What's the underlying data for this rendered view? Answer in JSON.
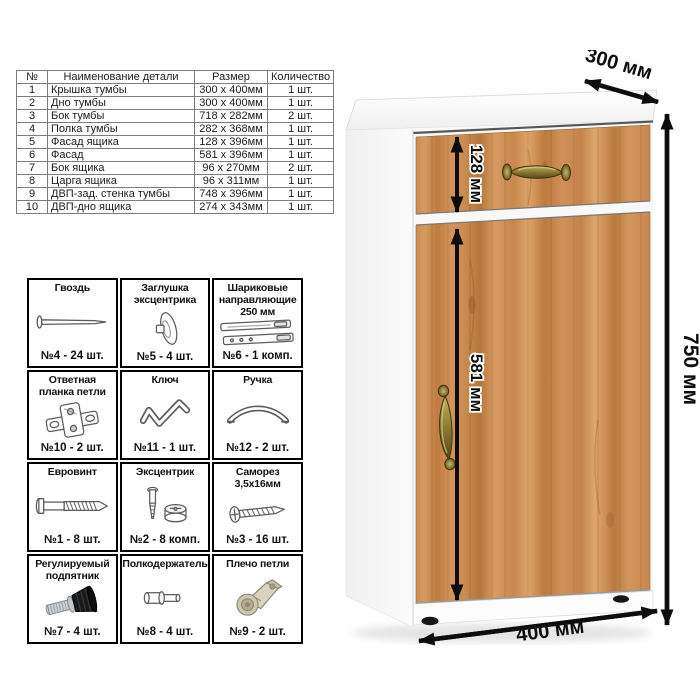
{
  "parts_table": {
    "headers": [
      "№",
      "Наименование детали",
      "Размер",
      "Количество"
    ],
    "rows": [
      [
        "1",
        "Крышка тумбы",
        "300 x 400мм",
        "1 шт."
      ],
      [
        "2",
        "Дно тумбы",
        "300 x 400мм",
        "1 шт."
      ],
      [
        "3",
        "Бок тумбы",
        "718 x 282мм",
        "2 шт."
      ],
      [
        "4",
        "Полка тумбы",
        "282 x 368мм",
        "1 шт."
      ],
      [
        "5",
        "Фасад ящика",
        "128 x 396мм",
        "1 шт."
      ],
      [
        "6",
        "Фасад",
        "581 x 396мм",
        "1 шт."
      ],
      [
        "7",
        "Бок ящика",
        "96 x 270мм",
        "2 шт."
      ],
      [
        "8",
        "Царга ящика",
        "96 x 311мм",
        "1 шт."
      ],
      [
        "9",
        "ДВП-зад. стенка тумбы",
        "748 x 396мм",
        "1 шт."
      ],
      [
        "10",
        "ДВП-дно ящика",
        "274 x 343мм",
        "1 шт."
      ]
    ]
  },
  "hardware": {
    "items": [
      {
        "name": "Гвоздь",
        "icon": "nail-icon",
        "count": "№4 - 24 шт."
      },
      {
        "name": "Заглушка эксцентрика",
        "icon": "cam-cap-icon",
        "count": "№5 - 4 шт."
      },
      {
        "name": "Шариковые направляющие 250 мм",
        "icon": "ball-slides-icon",
        "count": "№6 - 1 комп."
      },
      {
        "name": "Ответная планка петли",
        "icon": "hinge-plate-icon",
        "count": "№10 - 2 шт."
      },
      {
        "name": "Ключ",
        "icon": "hex-key-icon",
        "count": "№11 - 1 шт."
      },
      {
        "name": "Ручка",
        "icon": "handle-icon",
        "count": "№12 - 2 шт."
      },
      {
        "name": "Евровинт",
        "icon": "confirmat-screw-icon",
        "count": "№1 - 8 шт."
      },
      {
        "name": "Эксцентрик",
        "icon": "cam-lock-icon",
        "count": "№2 - 8 комп."
      },
      {
        "name": "Саморез 3,5х16мм",
        "icon": "screw-icon",
        "count": "№3 - 16 шт."
      },
      {
        "name": "Регулируемый подпятник",
        "icon": "adjustable-foot-icon",
        "count": "№7 - 4 шт."
      },
      {
        "name": "Полкодержатель",
        "icon": "shelf-pin-icon",
        "count": "№8 - 4 шт."
      },
      {
        "name": "Плечо петли",
        "icon": "hinge-arm-icon",
        "count": "№9 - 2 шт."
      }
    ]
  },
  "dimensions": {
    "depth": "300 мм",
    "height": "750 мм",
    "drawer_front": "128 мм",
    "door": "581 мм",
    "width": "400 мм"
  },
  "colors": {
    "wood_mid": "#c8874c",
    "wood_light": "#dda468",
    "wood_dark": "#b4763a",
    "brass": "#8a7a30",
    "dimension_black": "#0d0d0d",
    "carcass_white": "#fafafa"
  }
}
